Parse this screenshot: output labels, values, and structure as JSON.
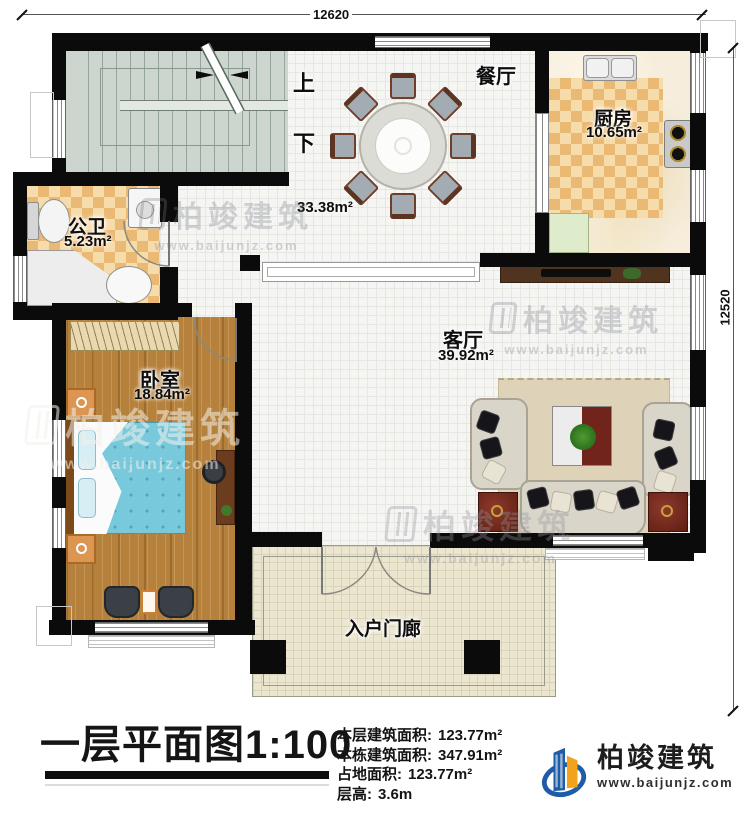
{
  "plan": {
    "dimensions": {
      "top": "12620",
      "right": "12520"
    },
    "stairs": {
      "up": "上",
      "down": "下"
    },
    "rooms": {
      "dining": {
        "name": "餐厅"
      },
      "dining_area": {
        "area": "33.38m²"
      },
      "kitchen": {
        "name": "厨房",
        "area": "10.65m²"
      },
      "bathroom": {
        "name": "公卫",
        "area": "5.23m²"
      },
      "bedroom": {
        "name": "卧室",
        "area": "18.84m²"
      },
      "living": {
        "name": "客厅",
        "area": "39.92m²"
      },
      "porch": {
        "name": "入户门廊"
      }
    }
  },
  "title_block": {
    "title": "一层平面图",
    "scale": "1:100",
    "stats": [
      {
        "label": "本层建筑面积:",
        "value": "123.77m²"
      },
      {
        "label": "本栋建筑面积:",
        "value": "347.91m²"
      },
      {
        "label": "占地面积:",
        "value": "123.77m²"
      },
      {
        "label": "层高:",
        "value": "3.6m"
      }
    ]
  },
  "branding": {
    "company": "柏竣建筑",
    "website": "www.baijunjz.com"
  },
  "watermark": {
    "company": "柏竣建筑",
    "website": "www.baijunjz.com"
  }
}
